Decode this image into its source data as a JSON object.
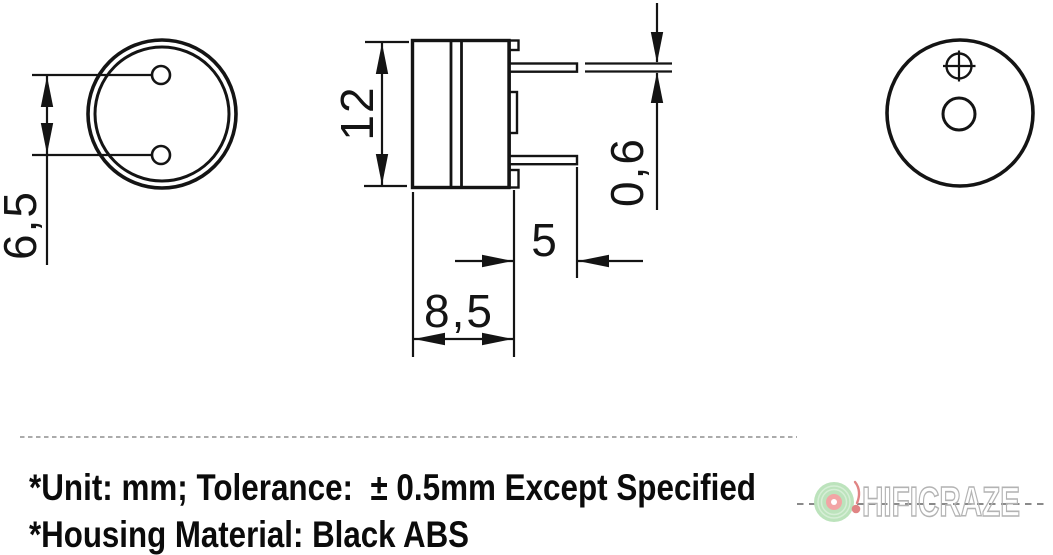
{
  "views": {
    "top": {
      "pin_pitch_label": "6,5"
    },
    "side": {
      "height_label": "12",
      "pin_thickness_label": "0,6",
      "pin_length_label": "5",
      "width_label": "8,5"
    }
  },
  "notes": {
    "line1": "*Unit: mm; Tolerance:  ± 0.5mm Except Specified",
    "line2": "*Housing Material: Black ABS"
  },
  "watermark": {
    "brand": "HIFICRAZE"
  },
  "colors": {
    "ink": "#141414",
    "note_text": "#0b0b0b",
    "separator": "#8f8f8f",
    "wm_dash": "#8a8a8a",
    "wm_disc": "#bce3bc",
    "wm_groove": "#d6eed6",
    "wm_label": "#f2a5a5",
    "wm_hole": "#ffffff",
    "wm_arm": "#e08484",
    "wm_text_outline": "#b3b3b3"
  }
}
